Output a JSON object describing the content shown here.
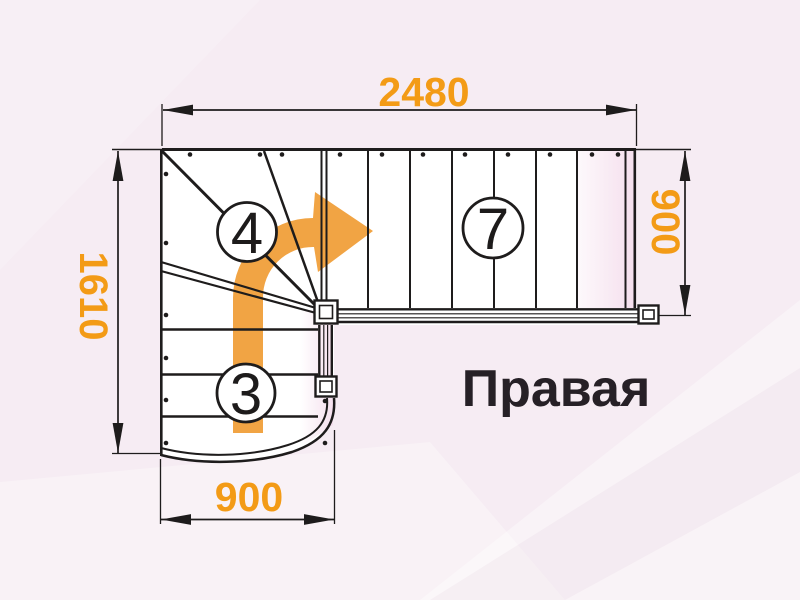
{
  "drawing": {
    "label": "Правая",
    "dims": {
      "top": "2480",
      "left": "1610",
      "right": "900",
      "bottom": "900"
    },
    "steps": {
      "upper_flight": "7",
      "winder": "4",
      "lower_flight": "3"
    },
    "colors": {
      "accent_orange": "#F39B16",
      "arrow_orange": "#F1A444",
      "line_black": "#1E1C1C",
      "background_pink": "#F6ECF3"
    }
  }
}
